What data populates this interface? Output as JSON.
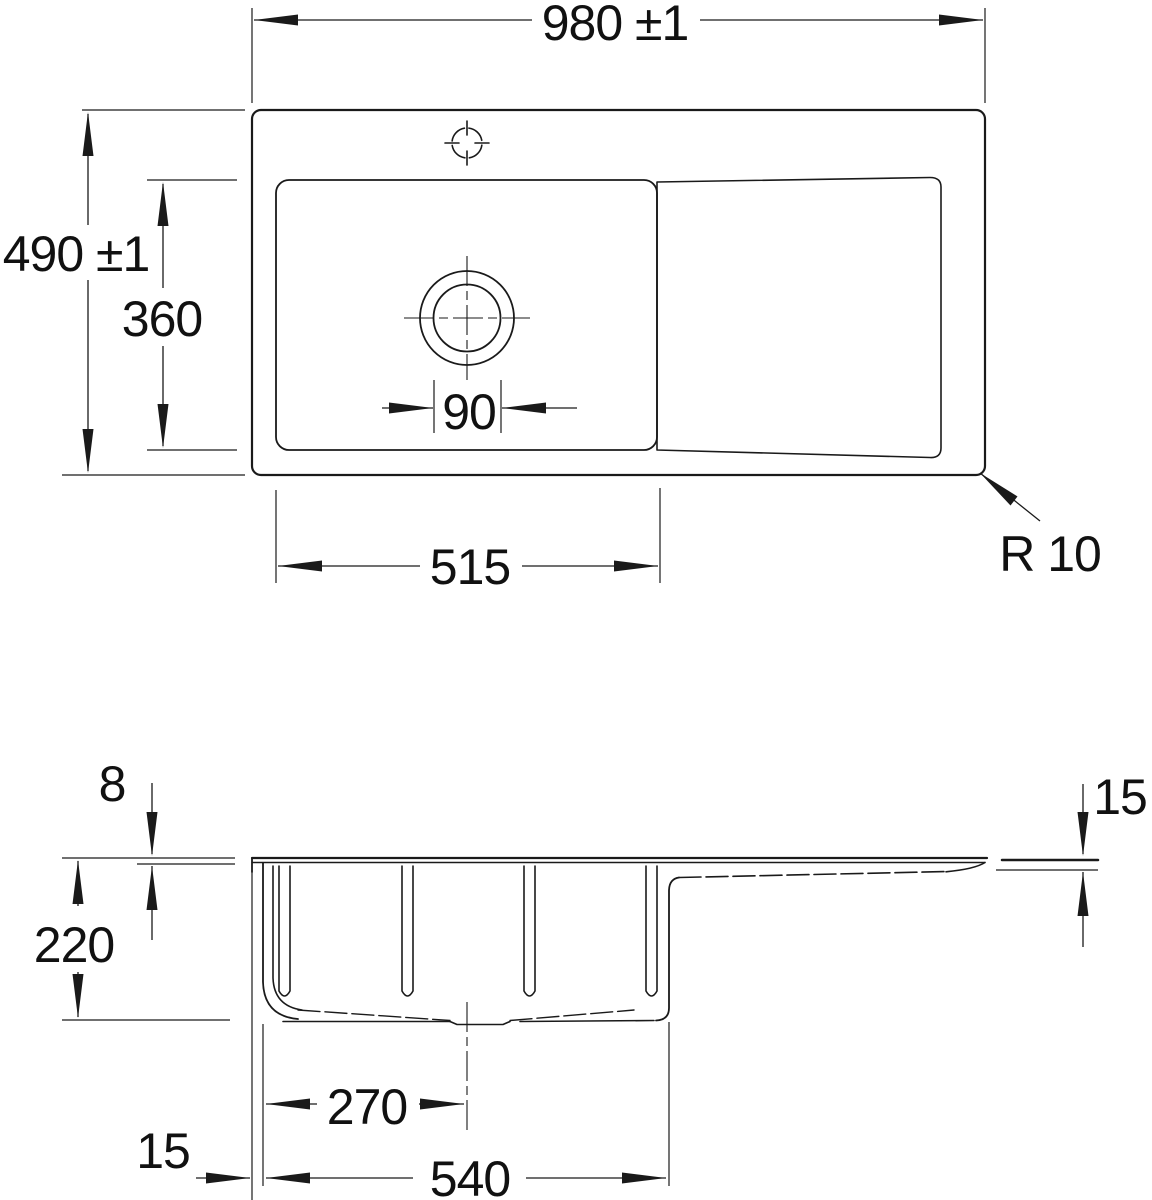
{
  "title": "Kitchen sink technical dimension drawing",
  "colors": {
    "line": "#1a1a1a",
    "background": "#ffffff"
  },
  "views": {
    "plan": "plan-view",
    "section": "section-view"
  },
  "dims": {
    "overall_width": "980 ±1",
    "overall_depth": "490 ±1",
    "bowl_front_to_back": "360",
    "drain_diameter": "90",
    "bowl_length": "515",
    "corner_radius": "R 10",
    "rim_thickness": "8",
    "bowl_depth": "220",
    "drain_center_offset": "270",
    "bowl_outer_length": "540",
    "edge_offset_left": "15",
    "drainboard_edge_drop": "15"
  }
}
